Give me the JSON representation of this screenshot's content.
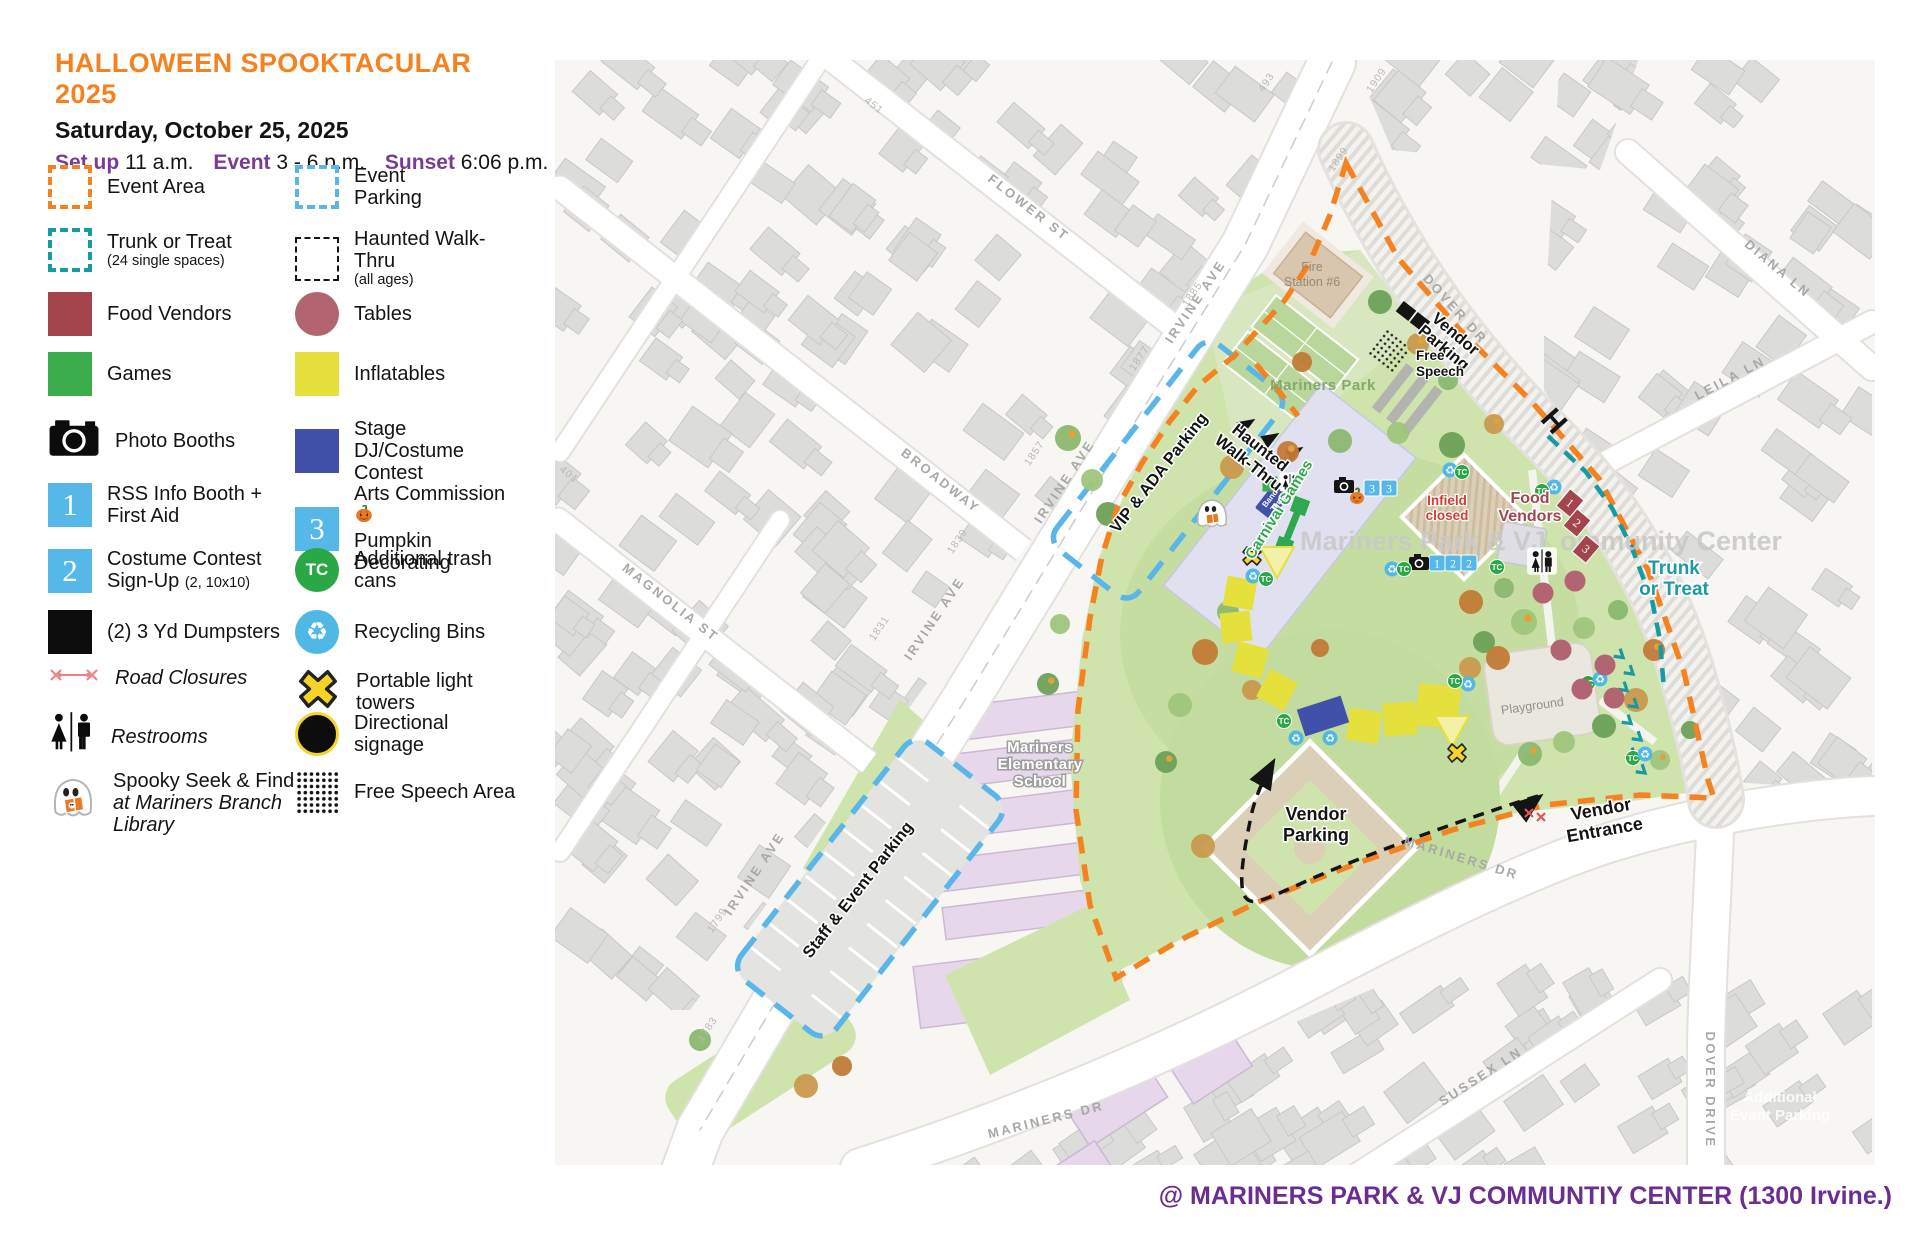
{
  "header": {
    "title": "HALLOWEEN SPOOKTACULAR 2025",
    "date": "Saturday, October 25, 2025",
    "setup_label": "Set up",
    "setup_value": "11 a.m.",
    "event_label": "Event",
    "event_value": "3 - 6 p.m.",
    "sunset_label": "Sunset",
    "sunset_value": "6:06 p.m."
  },
  "legend": {
    "col1": [
      {
        "icon": "event-area-swatch",
        "label": "Event Area"
      },
      {
        "icon": "trunk-or-treat-swatch",
        "label": "Trunk or Treat",
        "sub": "(24 single spaces)"
      },
      {
        "icon": "food-vendors-swatch",
        "label": "Food Vendors"
      },
      {
        "icon": "games-swatch",
        "label": "Games"
      },
      {
        "icon": "photo-booths-icon",
        "label": "Photo Booths"
      },
      {
        "icon": "info-booth-marker",
        "num": "1",
        "label": "RSS Info Booth +",
        "label2": "First Aid"
      },
      {
        "icon": "costume-signup-marker",
        "num": "2",
        "label": "Costume Contest",
        "label2": "Sign-Up",
        "sub_inline": "(2, 10x10)"
      },
      {
        "icon": "dumpsters-swatch",
        "label": "(2) 3 Yd Dumpsters"
      },
      {
        "icon": "road-closures-icon",
        "label": "Road Closures",
        "italic": true
      },
      {
        "icon": "restrooms-icon",
        "label": "Restrooms",
        "italic": true
      },
      {
        "icon": "spooky-ghost-icon",
        "label": "Spooky Seek & Find",
        "label2": "at Mariners Branch",
        "label3": "Library",
        "italic2": true
      }
    ],
    "col2": [
      {
        "icon": "event-parking-swatch",
        "label": "Event",
        "label2": "Parking"
      },
      {
        "icon": "haunted-walkthru-swatch",
        "label": "Haunted Walk-Thru",
        "sub": "(all ages)"
      },
      {
        "icon": "tables-swatch",
        "label": "Tables"
      },
      {
        "icon": "inflatables-swatch",
        "label": "Inflatables"
      },
      {
        "icon": "stage-swatch",
        "label": "Stage",
        "label2": "DJ/Costume Contest"
      },
      {
        "icon": "arts-commission-marker",
        "num": "3",
        "label": "Arts Commission",
        "label2": "Pumpkin Decorating",
        "pumpkin": true
      },
      {
        "icon": "trash-cans-icon",
        "label": "Additional trash",
        "label2": "cans"
      },
      {
        "icon": "recycling-icon",
        "label": "Recycling Bins"
      },
      {
        "icon": "light-towers-icon",
        "label": "Portable light towers"
      },
      {
        "icon": "directional-signage-icon",
        "label": "Directional",
        "label2": "signage"
      },
      {
        "icon": "free-speech-swatch",
        "label": "Free Speech Area"
      }
    ]
  },
  "map": {
    "street_labels": [
      {
        "text": "FLOWER ST",
        "x": 1026,
        "y": 211,
        "r": 38
      },
      {
        "text": "BROADWAY",
        "x": 938,
        "y": 484,
        "r": 38
      },
      {
        "text": "MAGNOLIA ST",
        "x": 668,
        "y": 606,
        "r": 38
      },
      {
        "text": "IRVINE AVE",
        "x": 1199,
        "y": 304,
        "r": -56
      },
      {
        "text": "IRVINE AVE",
        "x": 1068,
        "y": 484,
        "r": -56
      },
      {
        "text": "IRVINE AVE",
        "x": 938,
        "y": 621,
        "r": -56
      },
      {
        "text": "IRVINE AVE",
        "x": 758,
        "y": 876,
        "r": -56
      },
      {
        "text": "MARINERS DR",
        "x": 1460,
        "y": 862,
        "r": 17
      },
      {
        "text": "MARINERS DR",
        "x": 1047,
        "y": 1124,
        "r": -14
      },
      {
        "text": "DOVER DR",
        "x": 1452,
        "y": 312,
        "r": 48
      },
      {
        "text": "DIANA LN",
        "x": 1775,
        "y": 272,
        "r": 40
      },
      {
        "text": "LEILA LN",
        "x": 1732,
        "y": 382,
        "r": -28
      },
      {
        "text": "SUSSEX LN",
        "x": 1483,
        "y": 1080,
        "r": -33
      },
      {
        "text": "DOVER DRIVE",
        "x": 1706,
        "y": 1090,
        "r": 90
      }
    ],
    "address_numbers": [
      {
        "text": "451",
        "x": 872,
        "y": 108,
        "r": 38
      },
      {
        "text": "401",
        "x": 567,
        "y": 477,
        "r": 38
      },
      {
        "text": "493",
        "x": 1269,
        "y": 84,
        "r": -56
      },
      {
        "text": "1909",
        "x": 1379,
        "y": 82,
        "r": -56
      },
      {
        "text": "1899",
        "x": 1341,
        "y": 161,
        "r": -56
      },
      {
        "text": "1885",
        "x": 1195,
        "y": 296,
        "r": -56
      },
      {
        "text": "1877",
        "x": 1142,
        "y": 360,
        "r": -56
      },
      {
        "text": "1857",
        "x": 1037,
        "y": 455,
        "r": -56
      },
      {
        "text": "1839",
        "x": 960,
        "y": 543,
        "r": -56
      },
      {
        "text": "1831",
        "x": 882,
        "y": 630,
        "r": -56
      },
      {
        "text": "1799",
        "x": 720,
        "y": 922,
        "r": -56
      },
      {
        "text": "1783",
        "x": 710,
        "y": 1031,
        "r": -56
      }
    ],
    "place_labels": [
      {
        "text": "Fire",
        "x": 1312,
        "y": 271,
        "cls": "fire"
      },
      {
        "text": "Station #6",
        "x": 1312,
        "y": 286,
        "cls": "fire"
      },
      {
        "text": "Mariners Park",
        "x": 1323,
        "y": 390,
        "cls": "parkname"
      },
      {
        "text": "Mariners Park & VJ",
        "x": 1300,
        "y": 550,
        "cls": "watermark"
      },
      {
        "text": "ommunity Center",
        "x": 1560,
        "y": 550,
        "cls": "watermark"
      },
      {
        "text": "Mariners",
        "x": 1040,
        "y": 752,
        "cls": "school"
      },
      {
        "text": "Elementary",
        "x": 1040,
        "y": 769,
        "cls": "school"
      },
      {
        "text": "School",
        "x": 1040,
        "y": 786,
        "cls": "school"
      },
      {
        "text": "Playground",
        "x": 1533,
        "y": 710,
        "cls": "playground",
        "r": -8
      }
    ],
    "overlays": [
      {
        "lines": [
          "Vendor",
          "Parking"
        ],
        "x": 1452,
        "y": 338,
        "r": 40,
        "cls": "ob",
        "lh": 18
      },
      {
        "lines": [
          "Free",
          "Speech"
        ],
        "x": 1416,
        "y": 360,
        "cls": "smallB",
        "lh": 16
      },
      {
        "lines": [
          "Haunted",
          "Walk-Thru"
        ],
        "x": 1257,
        "y": 452,
        "r": 38,
        "cls": "ob",
        "lh": 19
      },
      {
        "lines": [
          "VIP & ADA Parking"
        ],
        "x": 1163,
        "y": 476,
        "r": -52,
        "cls": "ob"
      },
      {
        "lines": [
          "Staff & Event Parking"
        ],
        "x": 862,
        "y": 893,
        "r": -52,
        "cls": "ob"
      },
      {
        "lines": [
          "Carnival Games"
        ],
        "x": 1283,
        "y": 512,
        "r": -58,
        "cls": "green"
      },
      {
        "lines": [
          "Band",
          "Tent"
        ],
        "x": 1272,
        "y": 500,
        "r": -52,
        "cls": "tinyW",
        "lh": 9
      },
      {
        "lines": [
          "Infield",
          "closed"
        ],
        "x": 1447,
        "y": 505,
        "cls": "red",
        "lh": 15
      },
      {
        "lines": [
          "Food",
          "Vendors"
        ],
        "x": 1530,
        "y": 503,
        "cls": "maroon",
        "lh": 18
      },
      {
        "lines": [
          "Trunk",
          "or Treat"
        ],
        "x": 1674,
        "y": 574,
        "cls": "teal",
        "lh": 21
      },
      {
        "lines": [
          "Vendor",
          "Parking"
        ],
        "x": 1316,
        "y": 820,
        "cls": "obBig",
        "lh": 21
      },
      {
        "lines": [
          "Vendor",
          "Entrance"
        ],
        "x": 1602,
        "y": 815,
        "r": -10,
        "cls": "obBig",
        "lh": 21
      },
      {
        "lines": [
          "Additional",
          "Event Parking"
        ],
        "x": 1780,
        "y": 1102,
        "cls": "faint",
        "lh": 18
      }
    ],
    "markers": [
      {
        "t": "num",
        "v": "3",
        "x": 1372,
        "y": 488
      },
      {
        "t": "num",
        "v": "3",
        "x": 1389,
        "y": 488
      },
      {
        "t": "num",
        "v": "1",
        "x": 1437,
        "y": 563
      },
      {
        "t": "num",
        "v": "2",
        "x": 1453,
        "y": 563
      },
      {
        "t": "num",
        "v": "2",
        "x": 1469,
        "y": 563
      },
      {
        "t": "cam",
        "x": 1344,
        "y": 486
      },
      {
        "t": "cam",
        "x": 1419,
        "y": 563
      },
      {
        "t": "pump",
        "x": 1357,
        "y": 499
      },
      {
        "t": "rr",
        "x": 1290,
        "y": 482,
        "s": 0.8
      },
      {
        "t": "rr",
        "x": 1542,
        "y": 561,
        "s": 1.15
      },
      {
        "t": "rec",
        "x": 1253,
        "y": 576
      },
      {
        "t": "tc",
        "x": 1266,
        "y": 579
      },
      {
        "t": "rec",
        "x": 1392,
        "y": 569
      },
      {
        "t": "tc",
        "x": 1404,
        "y": 569
      },
      {
        "t": "rec",
        "x": 1450,
        "y": 470
      },
      {
        "t": "tc",
        "x": 1462,
        "y": 472
      },
      {
        "t": "rec",
        "x": 1554,
        "y": 487
      },
      {
        "t": "tc",
        "x": 1542,
        "y": 491
      },
      {
        "t": "tc",
        "x": 1497,
        "y": 567
      },
      {
        "t": "rec",
        "x": 1468,
        "y": 684
      },
      {
        "t": "tc",
        "x": 1455,
        "y": 681
      },
      {
        "t": "tc",
        "x": 1284,
        "y": 721
      },
      {
        "t": "rec",
        "x": 1296,
        "y": 738
      },
      {
        "t": "rec",
        "x": 1330,
        "y": 738
      },
      {
        "t": "tc",
        "x": 1588,
        "y": 683
      },
      {
        "t": "rec",
        "x": 1600,
        "y": 679
      },
      {
        "t": "tc",
        "x": 1633,
        "y": 758
      },
      {
        "t": "rec",
        "x": 1645,
        "y": 754
      },
      {
        "t": "x",
        "x": 1252,
        "y": 556
      },
      {
        "t": "x",
        "x": 1457,
        "y": 753
      },
      {
        "t": "tbl",
        "x": 1543,
        "y": 593
      },
      {
        "t": "tbl",
        "x": 1575,
        "y": 581
      },
      {
        "t": "tbl",
        "x": 1561,
        "y": 650
      },
      {
        "t": "tbl",
        "x": 1605,
        "y": 665
      },
      {
        "t": "tbl",
        "x": 1582,
        "y": 689
      },
      {
        "t": "tbl",
        "x": 1614,
        "y": 698
      },
      {
        "t": "dump",
        "x": 1406,
        "y": 311
      },
      {
        "t": "dump",
        "x": 1420,
        "y": 322
      },
      {
        "t": "grn",
        "x": 1270,
        "y": 484
      },
      {
        "t": "H",
        "x": 1554,
        "y": 421
      },
      {
        "t": "rx",
        "x": 1529,
        "y": 813
      },
      {
        "t": "rx",
        "x": 1541,
        "y": 817
      },
      {
        "t": "ghost",
        "x": 1212,
        "y": 516
      }
    ],
    "food_stalls": [
      {
        "v": "1",
        "x": 1570,
        "y": 503
      },
      {
        "v": "2",
        "x": 1577,
        "y": 523
      },
      {
        "v": "3",
        "x": 1586,
        "y": 549
      }
    ],
    "inflatables": {
      "squares": [
        [
          1240,
          593,
          10,
          30
        ],
        [
          1236,
          627,
          -6,
          30
        ],
        [
          1250,
          660,
          14,
          31
        ],
        [
          1277,
          690,
          28,
          31
        ],
        [
          1364,
          726,
          8,
          32
        ],
        [
          1400,
          719,
          -4,
          33
        ],
        [
          1438,
          706,
          6,
          42
        ]
      ],
      "triangles": [
        [
          1277,
          562
        ],
        [
          1452,
          731
        ]
      ],
      "stage": {
        "x": 1323,
        "y": 716,
        "r": -18,
        "w": 46,
        "h": 28
      }
    }
  },
  "footer": {
    "venue": "@ MARINERS PARK & VJ COMMUNTIY CENTER (1300 Irvine.)"
  },
  "colors": {
    "accent_orange": "#f5821f",
    "heading_purple": "#7a3b96",
    "footer_purple": "#6b2d90",
    "trunk_teal": "#189aa2",
    "parking_blue": "#5ab5e8",
    "marker_blue": "#56b8e8",
    "food_maroon": "#a4454e",
    "table_maroon": "#b26570",
    "games_green": "#3cad4c",
    "trash_green": "#2aa845",
    "inflatable_yellow": "#e5e03b",
    "stage_blue": "#4150a8",
    "light_tower_yellow": "#f5d327",
    "recycle_blue": "#4fb8e5"
  }
}
